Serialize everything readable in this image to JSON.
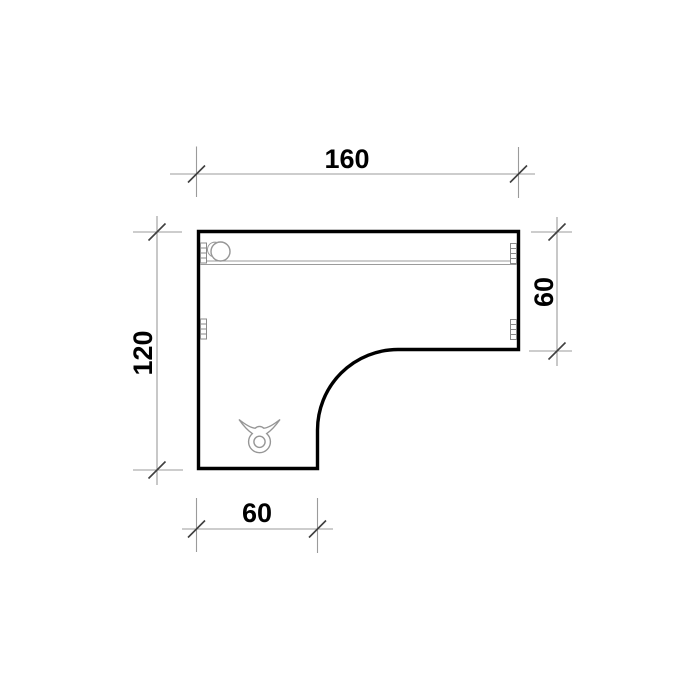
{
  "drawing": {
    "dimensions": {
      "top": "160",
      "right": "60",
      "left": "120",
      "bottom": "60"
    },
    "colors": {
      "background": "#ffffff",
      "desk_outline": "#000000",
      "dimension_lines": "#9b9b9b",
      "tick_marks": "#3f3f3f",
      "dimension_text": "#000000",
      "detail_lines": "#969696"
    },
    "icons": {
      "grommet": "cable-grommet-icon",
      "bracket": "mounting-bracket-icon",
      "clamp": "cable-clamp-icon"
    }
  }
}
